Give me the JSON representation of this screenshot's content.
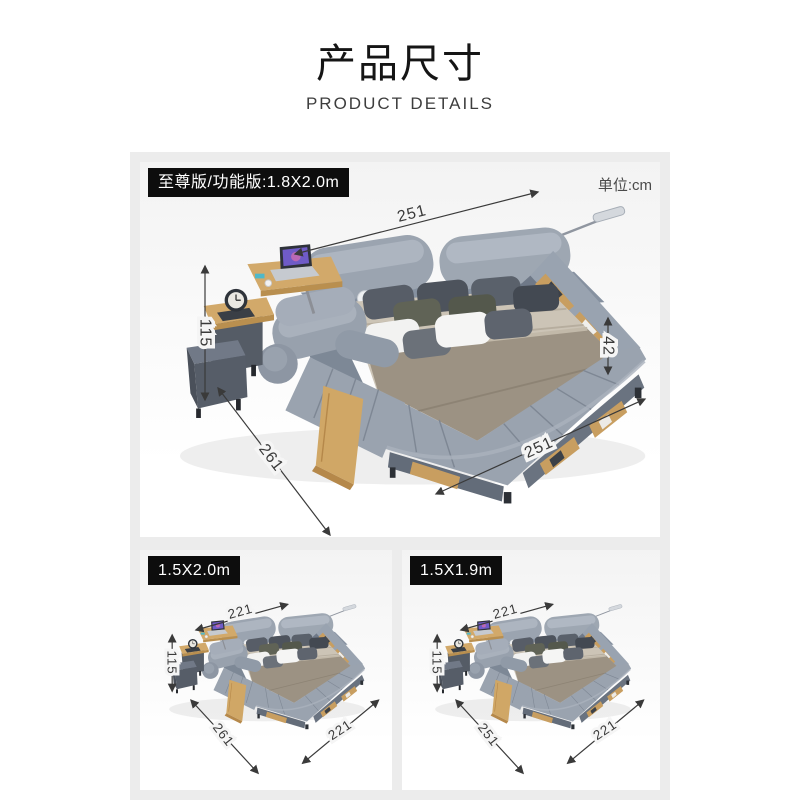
{
  "header": {
    "title": "产品尺寸",
    "subtitle": "PRODUCT DETAILS"
  },
  "unit_label": "单位:cm",
  "panels": {
    "main": {
      "badge": "至尊版/功能版:1.8X2.0m",
      "dims": {
        "top": "251",
        "left": "115",
        "right": "42",
        "bottom_left": "261",
        "bottom_right": "251"
      }
    },
    "bottom_left": {
      "badge": "1.5X2.0m",
      "dims": {
        "top": "221",
        "left": "115",
        "bottom_left": "261",
        "bottom_right": "221"
      }
    },
    "bottom_right": {
      "badge": "1.5X1.9m",
      "dims": {
        "top": "221",
        "left": "115",
        "bottom_left": "251",
        "bottom_right": "221"
      }
    }
  },
  "colors": {
    "badge_bg": "#0d0d0d",
    "badge_text": "#ffffff",
    "dimension_lines": "#3a3a3a",
    "board_bg": "#ececec",
    "bed_fabric": "#98a1ad",
    "wood": "#c89e60"
  }
}
